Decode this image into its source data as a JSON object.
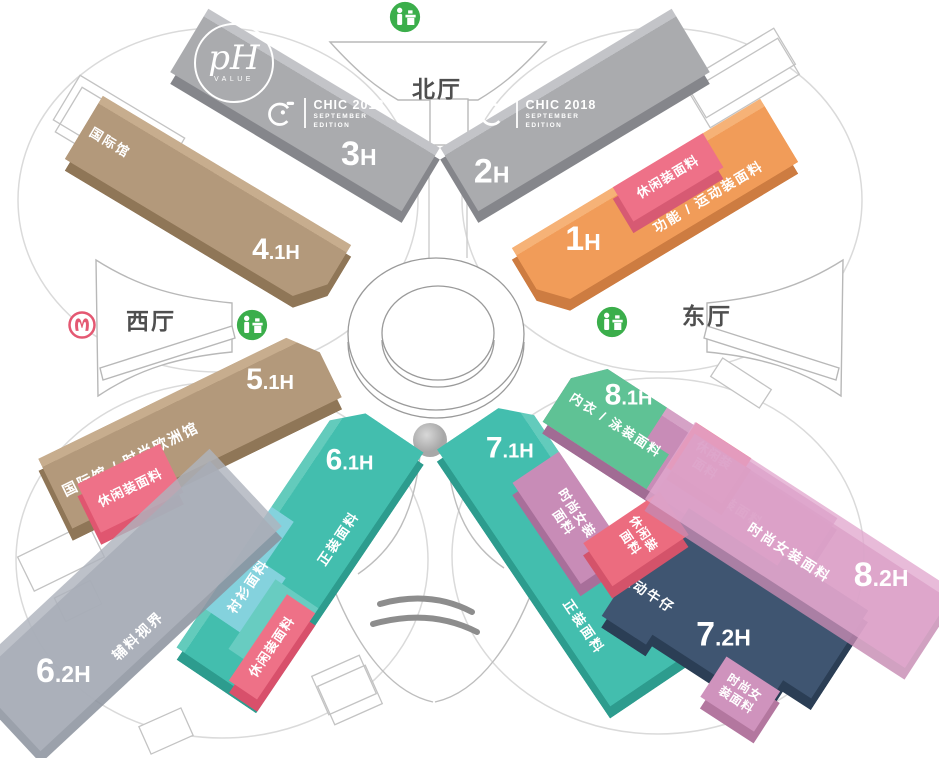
{
  "palette": {
    "hall_gray": "#aaabae",
    "hall_gray_side": "#85868b",
    "hall_tan": "#b3997b",
    "hall_tan_side": "#8f7657",
    "hall_orange": "#f19c59",
    "hall_orange_side": "#cd7c41",
    "hall_teal": "#43beae",
    "hall_teal_side": "#2d9c8e",
    "hall_navy": "#3f5571",
    "hall_navy_side": "#2b3e55",
    "hall_green": "#5fc295",
    "hall_mauve": "#c88cb7",
    "hall_mauve_side": "#a16c94",
    "patch_pink": "#ee7188",
    "patch_pink_side": "#d75a73",
    "patch_red": "#ec6c7f",
    "patch_blue": "#84d2dd",
    "overlay_gray": "#aeb3bd",
    "overlay_pink": "#e2aace",
    "icon_green": "#3bae4b",
    "metro_red": "#e45872"
  },
  "logos": {
    "ph": {
      "monogram": "pH",
      "caption": "VALUE"
    },
    "chic": {
      "title": "CHIC 2018",
      "sub1": "SEPTEMBER",
      "sub2": "EDITION"
    }
  },
  "lobbies": {
    "north": "北厅",
    "west": "西厅",
    "east": "东厅"
  },
  "icons": {
    "registration": "registration-desk",
    "metro": "shanghai-metro"
  },
  "halls": {
    "h1": {
      "num": "1",
      "suffix": "H",
      "zone": "功能 / 运动装面料",
      "patch_casual": "休闲装面料"
    },
    "h2": {
      "num": "2",
      "suffix": "H"
    },
    "h3": {
      "num": "3",
      "suffix": "H"
    },
    "h41": {
      "num": "4",
      "suffix": ".1H",
      "corner": "国际馆"
    },
    "h51": {
      "num": "5",
      "suffix": ".1H",
      "zone": "国际馆 / 时尚欧洲馆",
      "patch_casual": "休闲装面料"
    },
    "h61": {
      "num": "6",
      "suffix": ".1H",
      "zone_shirt": "衬衫面料",
      "zone_formal": "正装面料",
      "patch_casual": "休闲装面料"
    },
    "h62": {
      "num": "6",
      "suffix": ".2H",
      "zone": "辅料视界"
    },
    "h71": {
      "num": "7",
      "suffix": ".1H",
      "zone_women": "时尚女装\n面料",
      "zone_formal": "正装面料",
      "patch_casual": "休闲装\n面料"
    },
    "h72": {
      "num": "7",
      "suffix": ".2H",
      "zone_denim": "跃动牛仔",
      "patch_women": "时尚女\n装面料"
    },
    "h81": {
      "num": "8",
      "suffix": ".1H",
      "zone_lingerie": "内衣 / 泳装面料",
      "zone_women": "时尚女装面料",
      "patch_casual": "休闲装\n面料"
    },
    "h82": {
      "num": "8",
      "suffix": ".2H",
      "zone": "时尚女装面料"
    }
  }
}
